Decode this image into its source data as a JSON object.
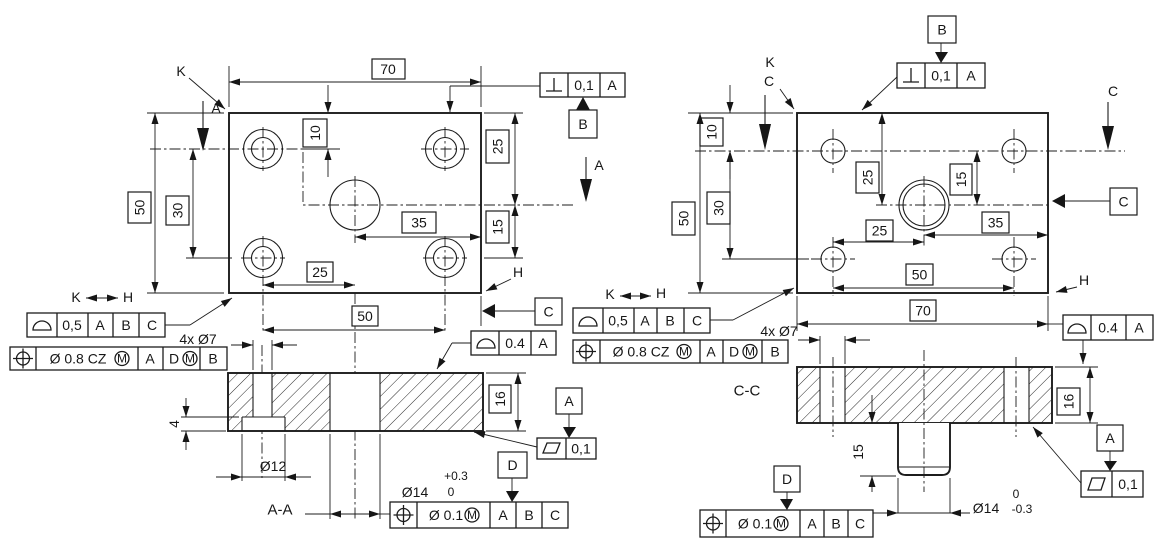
{
  "drawing": {
    "left": {
      "dims": {
        "width_top": "70",
        "height_left": "50",
        "holes_vert": "30",
        "edge_offset": "10",
        "right_upper": "25",
        "right_lower": "15",
        "center_to_edge": "35",
        "holes_horiz_lower": "25",
        "holes_horiz": "50",
        "thickness": "16",
        "cbore_dia": "Ø12",
        "cbore_depth": "4",
        "hole_count_note": "4x Ø7",
        "center_hole_dia": "Ø14",
        "center_tol_upper": "+0.3",
        "center_tol_lower": "0"
      },
      "labels": {
        "corner_k": "K",
        "corner_h": "H",
        "section_arrow": "A",
        "section_name": "A-A",
        "between_k": "K",
        "between_h": "H"
      },
      "datums": {
        "a": "A",
        "b": "B",
        "c": "C",
        "d": "D"
      },
      "fcf": {
        "perp": {
          "tol": "0,1",
          "d1": "A"
        },
        "profile_kh": {
          "tol": "0,5",
          "d1": "A",
          "d2": "B",
          "d3": "C"
        },
        "pos_holes": {
          "tol": "Ø 0.8 CZ",
          "mod": "M",
          "d1": "A",
          "d2": "D",
          "d2_mod": "M",
          "d3": "B"
        },
        "profile_top": {
          "tol": "0.4",
          "d1": "A"
        },
        "flatness": {
          "tol": "0,1"
        },
        "pos_center": {
          "tol": "Ø 0.1",
          "mod": "M",
          "d1": "A",
          "d2": "B",
          "d3": "C"
        }
      }
    },
    "right": {
      "dims": {
        "width_bottom": "70",
        "height_left": "50",
        "holes_vert": "30",
        "edge_offset": "10",
        "center_from_top": "25",
        "center_from_holes": "15",
        "center_horiz": "25",
        "center_to_edge": "35",
        "holes_horiz": "50",
        "thickness": "16",
        "hole_count_note": "4x Ø7",
        "boss_length": "15",
        "boss_dia": "Ø14",
        "boss_tol_upper": "0",
        "boss_tol_lower": "-0.3"
      },
      "labels": {
        "corner_k": "K",
        "corner_c": "C",
        "section_arrow": "C",
        "section_name": "C-C",
        "corner_h": "H",
        "between_k": "K",
        "between_h": "H"
      },
      "datums": {
        "a": "A",
        "b": "B",
        "c": "C",
        "d": "D"
      },
      "fcf": {
        "perp": {
          "tol": "0,1",
          "d1": "A"
        },
        "profile_kh": {
          "tol": "0,5",
          "d1": "A",
          "d2": "B",
          "d3": "C"
        },
        "pos_holes": {
          "tol": "Ø 0.8 CZ",
          "mod": "M",
          "d1": "A",
          "d2": "D",
          "d2_mod": "M",
          "d3": "B"
        },
        "profile_top": {
          "tol": "0.4",
          "d1": "A"
        },
        "flatness": {
          "tol": "0,1"
        },
        "pos_center": {
          "tol": "Ø 0.1",
          "mod": "M",
          "d1": "A",
          "d2": "B",
          "d3": "C"
        }
      }
    }
  }
}
